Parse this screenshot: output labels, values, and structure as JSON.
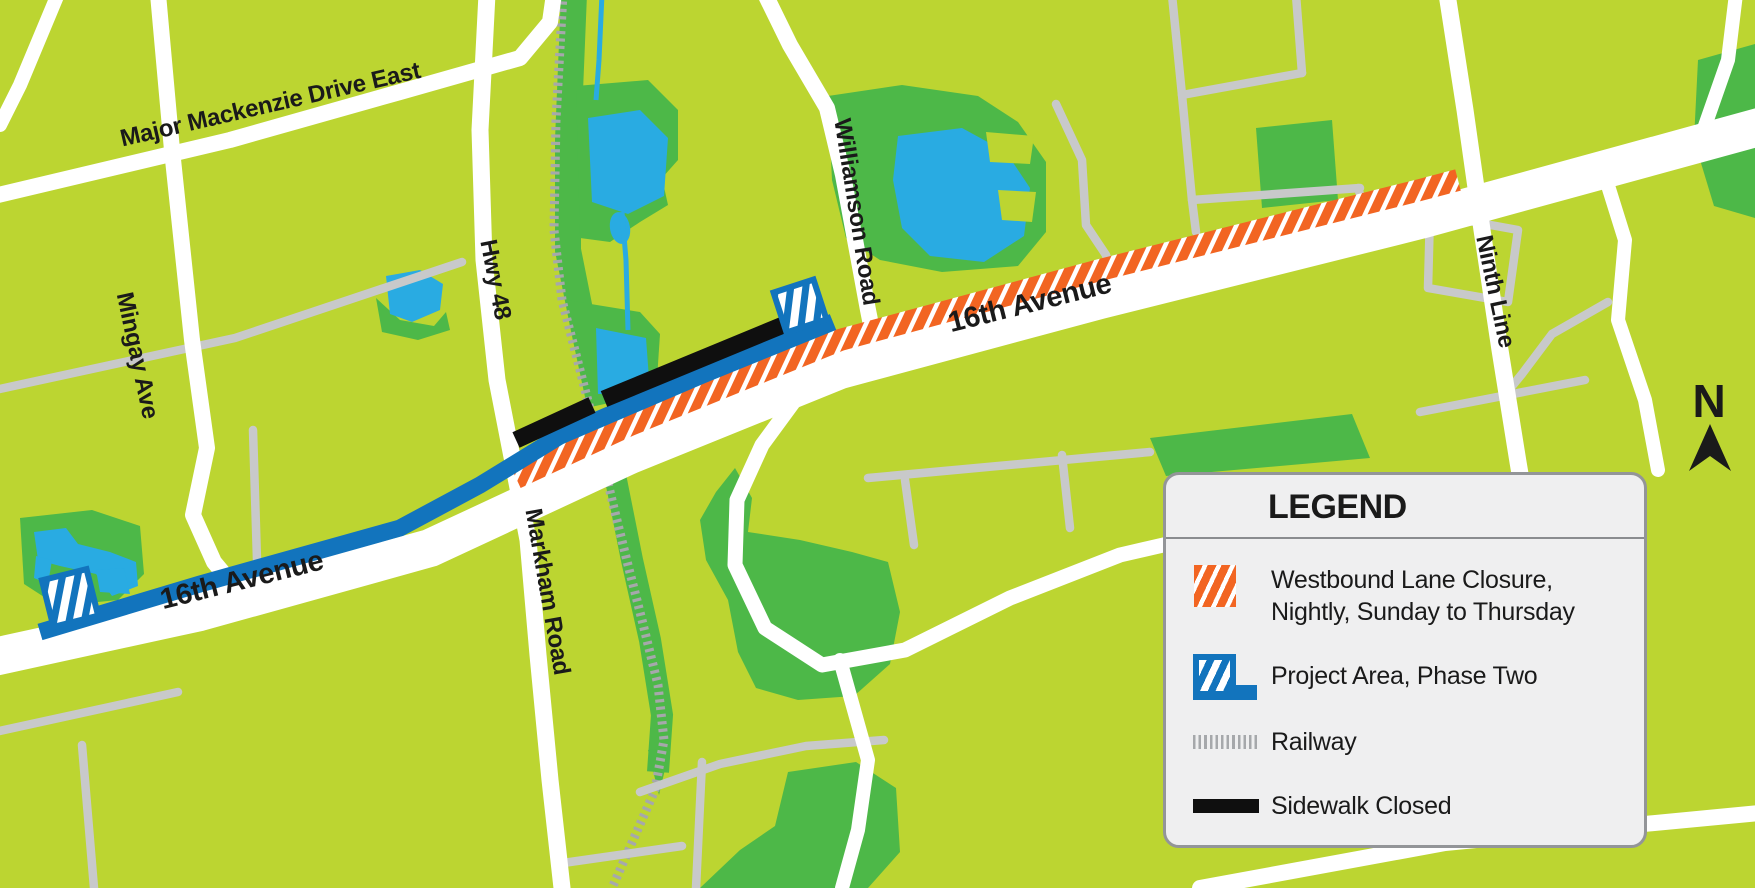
{
  "map": {
    "street_labels": [
      {
        "id": "major-mackenzie-drive-east",
        "text": "Major Mackenzie Drive East"
      },
      {
        "id": "mingay-ave",
        "text": "Mingay Ave"
      },
      {
        "id": "hwy-48",
        "text": "Hwy 48"
      },
      {
        "id": "williamson-road",
        "text": "Williamson Road"
      },
      {
        "id": "markham-road",
        "text": "Markham Road"
      },
      {
        "id": "ninth-line",
        "text": "Ninth Line"
      },
      {
        "id": "sixteenth-avenue-east",
        "text": "16th Avenue"
      },
      {
        "id": "sixteenth-avenue-west",
        "text": "16th Avenue"
      }
    ],
    "north_indicator": {
      "label": "N"
    },
    "colors": {
      "background": "#bcd531",
      "park": "#4db848",
      "water": "#29abe2",
      "road_major": "#ffffff",
      "road_minor": "#c8c9ca",
      "railway": "#a6a8ab",
      "closure_orange": "#f26522",
      "project_blue": "#1274bd",
      "sidewalk_black": "#0f0f0f",
      "label_text": "#1a1a1a",
      "legend_background": "#efeff0",
      "legend_border": "#939598"
    }
  },
  "legend": {
    "title": "LEGEND",
    "items": [
      {
        "id": "westbound-lane-closure",
        "swatch": "orange-hatch",
        "lines": [
          "Westbound Lane Closure,",
          "Nightly, Sunday to Thursday"
        ]
      },
      {
        "id": "project-area-phase-two",
        "swatch": "blue-hatch-band",
        "lines": [
          "Project Area, Phase Two"
        ]
      },
      {
        "id": "railway",
        "swatch": "railway-ticks",
        "lines": [
          "Railway"
        ]
      },
      {
        "id": "sidewalk-closed",
        "swatch": "black-bar",
        "lines": [
          "Sidewalk Closed"
        ]
      }
    ]
  }
}
